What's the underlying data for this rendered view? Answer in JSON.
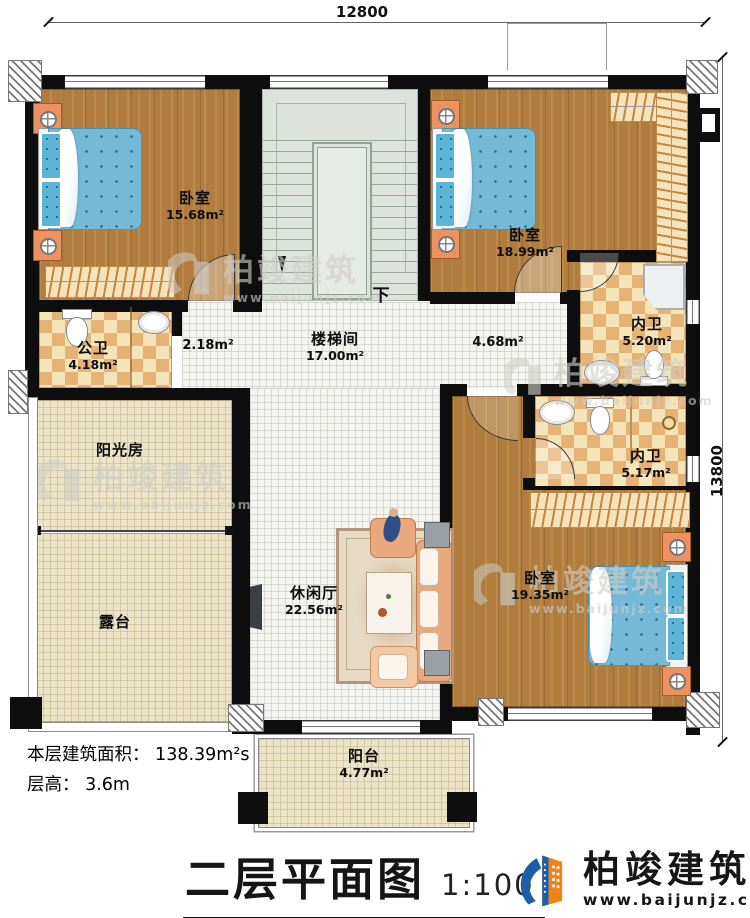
{
  "dims": {
    "top": "12800",
    "right": "13800"
  },
  "rooms": {
    "bedroom1": {
      "name": "卧室",
      "area": "15.68m²"
    },
    "bedroom2": {
      "name": "卧室",
      "area": "18.99m²"
    },
    "bedroom3": {
      "name": "卧室",
      "area": "19.35m²"
    },
    "stair_hall": {
      "name": "楼梯间",
      "area": "17.00m²"
    },
    "public_bath": {
      "name": "公卫",
      "area": "4.18m²"
    },
    "ensuite_top": {
      "name": "内卫",
      "area": "5.20m²"
    },
    "ensuite_mid": {
      "name": "内卫",
      "area": "5.17m²"
    },
    "sunroom": {
      "name": "阳光房"
    },
    "terrace": {
      "name": "露台"
    },
    "lounge": {
      "name": "休闲厅",
      "area": "22.56m²"
    },
    "balcony": {
      "name": "阳台",
      "area": "4.77m²"
    }
  },
  "labels": {
    "corridor_small": "2.18m²",
    "hall_small": "4.68m²",
    "stairs_down": "下"
  },
  "info": {
    "floor_area": "本层建筑面积： 138.39m²s",
    "floor_height": "层高： 3.6m"
  },
  "title": {
    "text": "二层平面图",
    "scale": "1:100"
  },
  "brand": {
    "name": "柏竣建筑",
    "url": "www.baijunjz.com"
  },
  "watermark": {
    "name": "柏竣建筑",
    "url": "www.baijunjz.com"
  }
}
